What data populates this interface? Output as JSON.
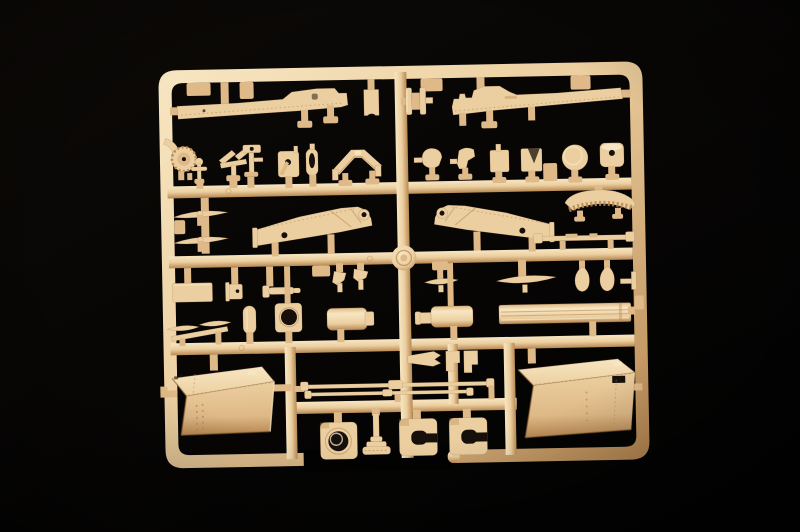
{
  "scene": {
    "subject": "Photograph of a tan injection-molded plastic model kit sprue (parts tree) on a black studio background",
    "plastic_finish": "matte tan styrene, warm light from upper left",
    "background": "near-black with subtle vignette",
    "visible_text": "none"
  },
  "palette": {
    "background-top": "#0d0a07",
    "background-bottom": "#020202",
    "plastic-light": "#f7e6c2",
    "plastic-base": "#eccfa0",
    "plastic-mid": "#dfb987",
    "plastic-shadow": "#b88953",
    "plastic-deep": "#8a5f33",
    "hole-dark": "#17100a"
  },
  "sprue": {
    "frame": {
      "shape": "rounded-rectangle outer frame, slightly tilted",
      "runners": "three full horizontal runners, one partial lower runner, central vertical runner, three short vertical connectors",
      "gate_boss": "round molded boss at the central runner crossing"
    },
    "parts": [
      {
        "name": "fender-strip-left",
        "count": 1,
        "desc": "long hull fender strip with raised cab step and rivet ticks, top left"
      },
      {
        "name": "fender-strip-right",
        "count": 1,
        "desc": "mirrored long fender strip, top right"
      },
      {
        "name": "mudflap-tab",
        "count": 1,
        "desc": "small plate with arched cutout, top center"
      },
      {
        "name": "return-roller",
        "count": 1,
        "desc": "double-flanged roller on axle pins, top center"
      },
      {
        "name": "sprocket-hub-with-arm",
        "count": 1,
        "desc": "toothed hub wheel with curved arm, row two far left"
      },
      {
        "name": "valve-pin",
        "count": 1,
        "desc": "round-head pin with cross arms"
      },
      {
        "name": "paddle-lever-pair",
        "count": 1,
        "desc": "two tilted paddles on a tee stand"
      },
      {
        "name": "hammer-lever",
        "count": 1,
        "desc": "post with hammer head and side arm"
      },
      {
        "name": "pivot-plate-with-crank",
        "count": 1,
        "desc": "plate with bore and diagonal crank"
      },
      {
        "name": "slotted-oval-plate",
        "count": 1,
        "desc": "upright plate with oval slot"
      },
      {
        "name": "gabled-bracket",
        "count": 1,
        "desc": "wide roof-shaped bracket with end flaps"
      },
      {
        "name": "cowl-bracket",
        "count": 2,
        "desc": "small rounded cowl brackets, row two right"
      },
      {
        "name": "square-plate",
        "count": 1,
        "desc": "plain square plate with top pin"
      },
      {
        "name": "notched-square-plate",
        "count": 1,
        "desc": "square plate with vee notch"
      },
      {
        "name": "round-disc",
        "count": 1,
        "desc": "flat circular disc"
      },
      {
        "name": "drum-with-bore",
        "count": 1,
        "desc": "short cylinder drum with center bore"
      },
      {
        "name": "leaf-spring-blade",
        "count": 2,
        "desc": "thin airfoil blades stacked, row three left"
      },
      {
        "name": "trail-frame-left",
        "count": 1,
        "desc": "large angled gun-trail side frame with tow ring and lightening hole"
      },
      {
        "name": "trail-frame-right",
        "count": 1,
        "desc": "mirrored gun-trail side frame"
      },
      {
        "name": "toothed-elevation-arc",
        "count": 1,
        "desc": "crescent rack segment with teeth on underside"
      },
      {
        "name": "tow-bar-rod",
        "count": 1,
        "desc": "thin rod with paddle ends"
      },
      {
        "name": "center-gate-boss",
        "count": 1,
        "desc": "round molding boss at runner crossing"
      },
      {
        "name": "rectangular-plate",
        "count": 1,
        "desc": "flat rectangular plate, row four left"
      },
      {
        "name": "flanged-bushing",
        "count": 1,
        "desc": "small bushing with end flange"
      },
      {
        "name": "axle-pin",
        "count": 1,
        "desc": "stepped horizontal pin with collar"
      },
      {
        "name": "chevron-bracket",
        "count": 2,
        "desc": "small bent brackets near center"
      },
      {
        "name": "swept-blade",
        "count": 2,
        "desc": "thin swept blades with center posts"
      },
      {
        "name": "teardrop-counterweight",
        "count": 2,
        "desc": "pear-shaped counterweights on stubs"
      },
      {
        "name": "tee-fitting",
        "count": 1,
        "desc": "small tee fitting on right rail"
      },
      {
        "name": "capsule-cover",
        "count": 1,
        "desc": "oval capsule cover"
      },
      {
        "name": "ring-aperture-plate",
        "count": 1,
        "desc": "square plate with large round aperture"
      },
      {
        "name": "recoil-cylinder",
        "count": 2,
        "desc": "mirrored stepped cylinders, center"
      },
      {
        "name": "ribbed-rail-beam",
        "count": 1,
        "desc": "long beam with longitudinal ribs, right"
      },
      {
        "name": "twin-leaf-spring",
        "count": 1,
        "desc": "two blades on a diagonal bar, left"
      },
      {
        "name": "stowage-box-left",
        "count": 1,
        "desc": "large riveted stowage box with hasps, bottom left"
      },
      {
        "name": "stowage-box-right",
        "count": 1,
        "desc": "large stowage box with slot, bottom right"
      },
      {
        "name": "swallowtail-bracket",
        "count": 1,
        "desc": "pennant-shaped bracket with notched tail"
      },
      {
        "name": "step-clip",
        "count": 2,
        "desc": "small stepped clips"
      },
      {
        "name": "tie-rod-long",
        "count": 2,
        "desc": "long thin linkage rods with center bosses"
      },
      {
        "name": "ring-aperture-block",
        "count": 1,
        "desc": "square block with round bore, bottom row"
      },
      {
        "name": "mushroom-valve",
        "count": 1,
        "desc": "stemmed part with wide ribbed foot"
      },
      {
        "name": "c-clamp-bracket",
        "count": 2,
        "desc": "square blocks with C-shaped channel, bottom row"
      }
    ]
  }
}
